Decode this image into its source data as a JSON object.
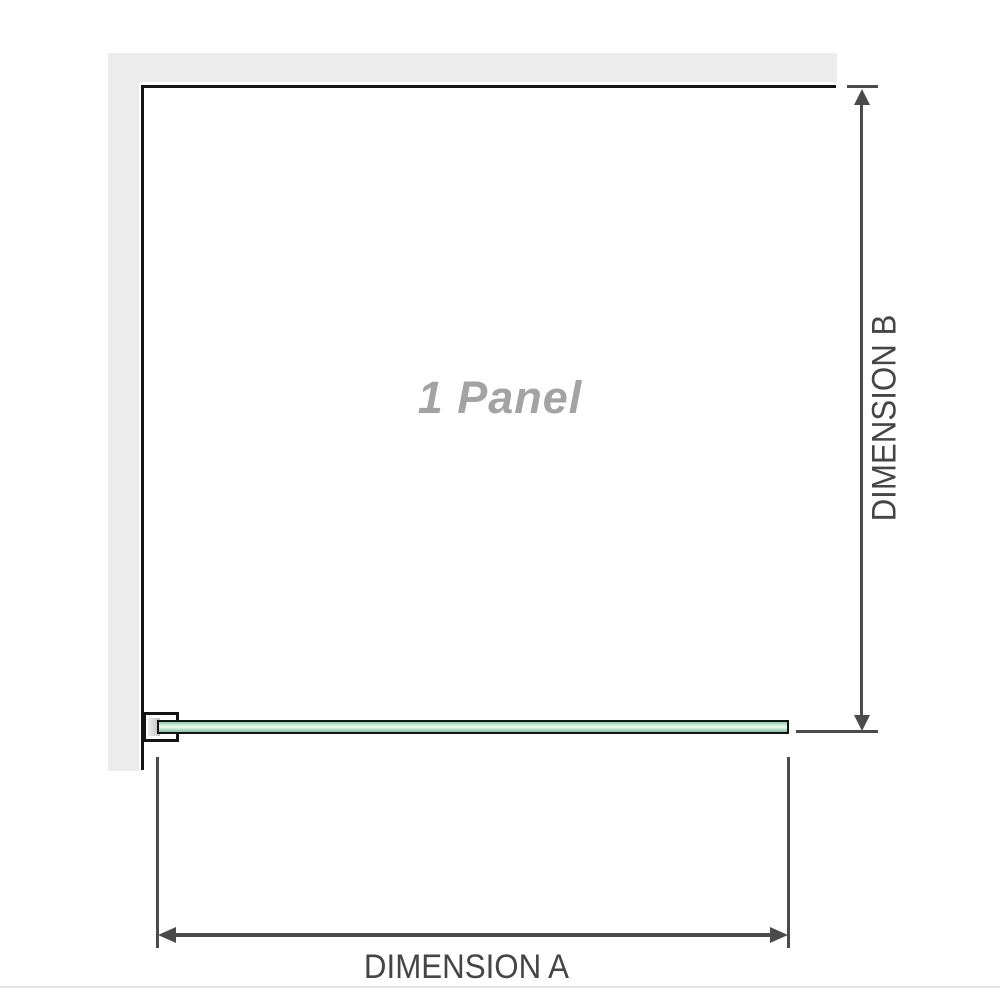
{
  "diagram": {
    "panel_label": "1 Panel",
    "dimension_a": {
      "label": "DIMENSION A"
    },
    "dimension_b": {
      "label": "DIMENSION B"
    }
  },
  "colors": {
    "background": "#ffffff",
    "wall": "#ececec",
    "opening_edge": "#151515",
    "dimension_line": "#4a4a4a",
    "dimension_text": "#454545",
    "panel_label_text": "#a3a3a3",
    "glass_border": "#141414",
    "glass_green_dark": "#8ac7a6",
    "glass_green_light": "#eef8f2",
    "bracket_fill": "#ffffff",
    "bracket_slot": "#cccccc",
    "baseline": "#e8e5e0"
  }
}
